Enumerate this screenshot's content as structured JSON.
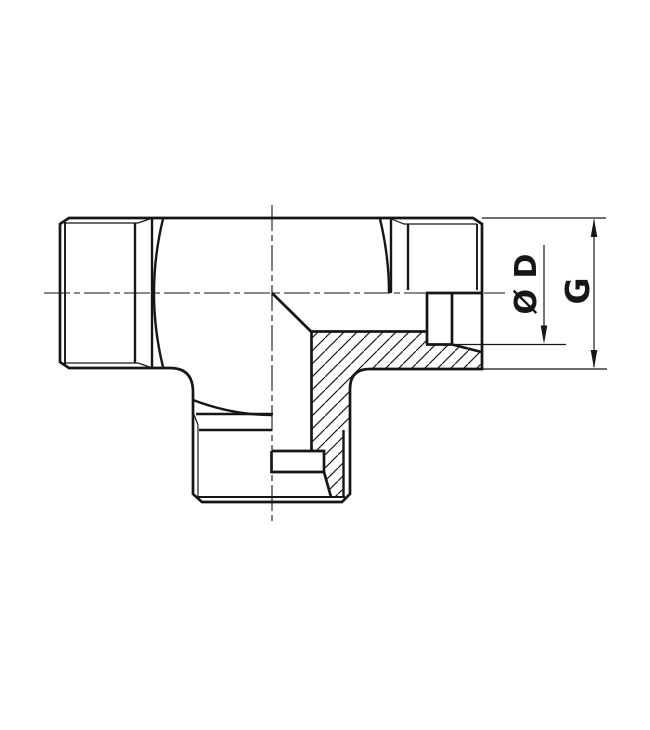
{
  "drawing": {
    "subject": "tee-fitting-cross-section",
    "labels": {
      "diameter": "Ø D",
      "thread_size": "G"
    },
    "colors": {
      "line": "#161616",
      "background": "#ffffff"
    },
    "icons": {
      "dimension_arrowheads": "filled-triangle-arrow"
    }
  }
}
